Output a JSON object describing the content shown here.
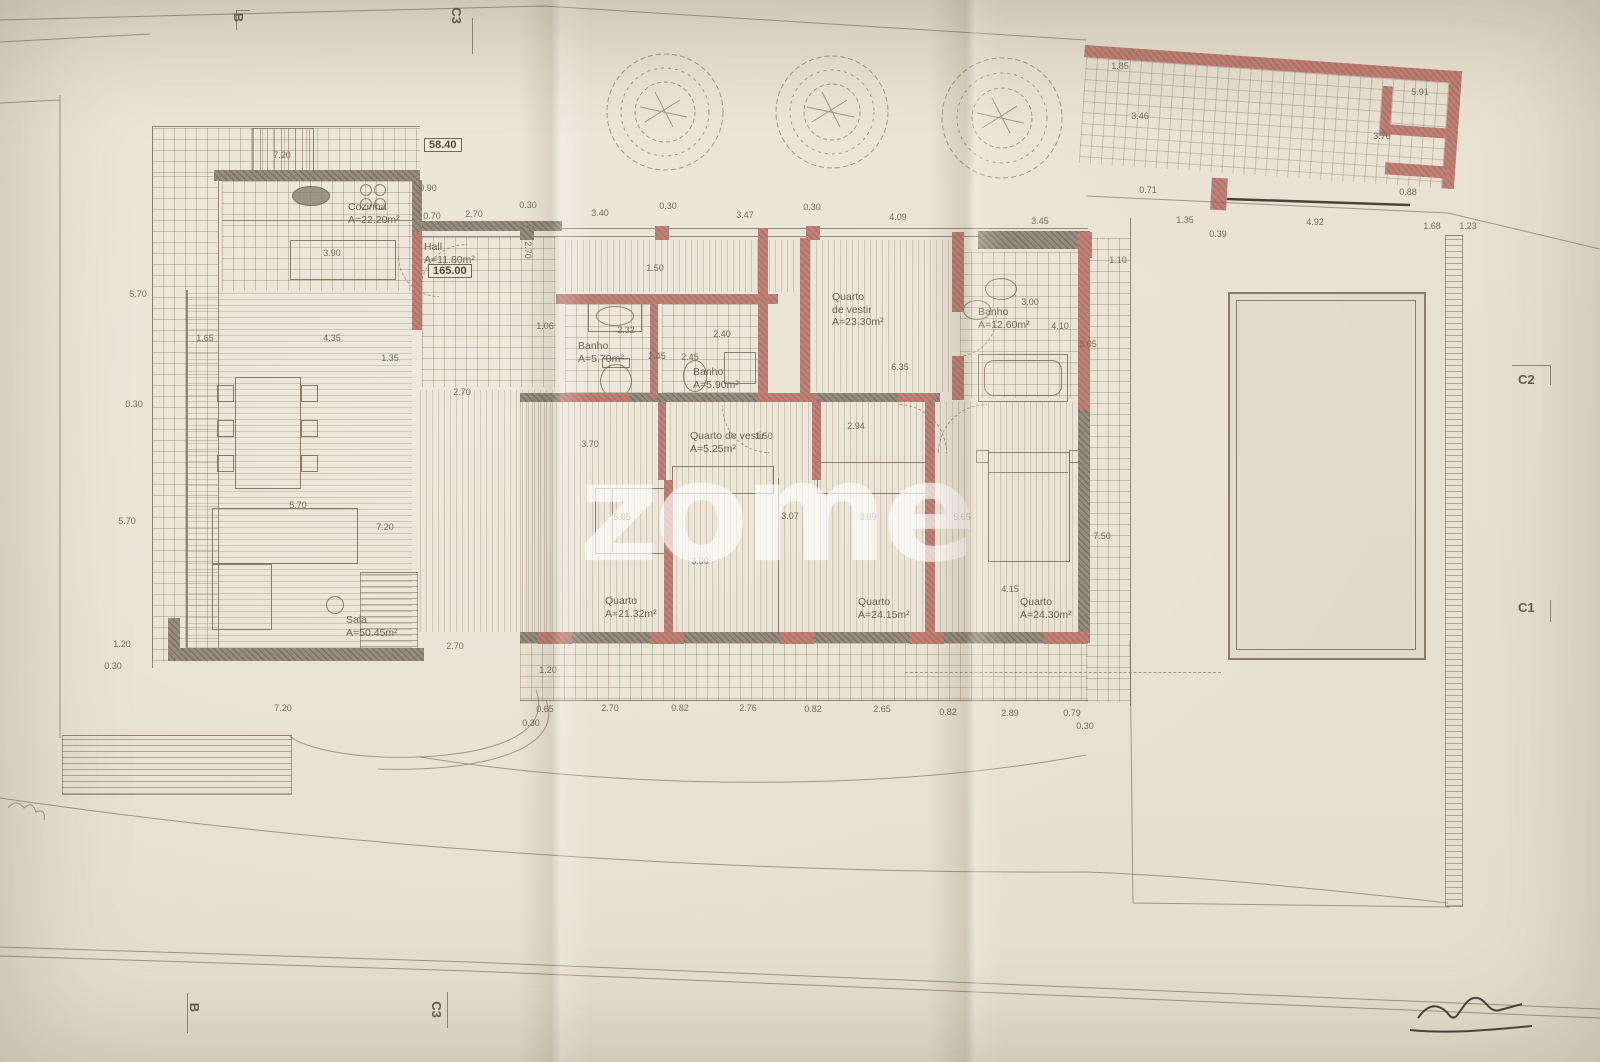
{
  "watermark": "zome",
  "colors": {
    "paper": "#e9e2d3",
    "wall_gray": "#978d7f",
    "wall_red": "#bd8177",
    "ink": "#746b5d",
    "signature": "#38332b"
  },
  "plan": {
    "rooms": [
      {
        "id": "cozinha",
        "lines": [
          "Cozinha",
          "A=22.20m²"
        ],
        "x": 348,
        "y": 201
      },
      {
        "id": "hall",
        "lines": [
          "Hall",
          "A=11.80m²"
        ],
        "x": 424,
        "y": 241
      },
      {
        "id": "banho-1",
        "lines": [
          "Banho",
          "A=5.70m²"
        ],
        "x": 578,
        "y": 340
      },
      {
        "id": "banho-2",
        "lines": [
          "Banho",
          "A=5.90m²"
        ],
        "x": 693,
        "y": 366
      },
      {
        "id": "quarto-vestir-1",
        "lines": [
          "Quarto",
          "de vestir",
          "A=23.30m²"
        ],
        "x": 832,
        "y": 291
      },
      {
        "id": "banho-3",
        "lines": [
          "Banho",
          "A=12.60m²"
        ],
        "x": 978,
        "y": 306
      },
      {
        "id": "quarto-vestir-2",
        "lines": [
          "Quarto de vestir",
          "A=5.25m²"
        ],
        "x": 690,
        "y": 430
      },
      {
        "id": "quarto-1",
        "lines": [
          "Quarto",
          "A=21.32m²"
        ],
        "x": 605,
        "y": 595
      },
      {
        "id": "quarto-2",
        "lines": [
          "Quarto",
          "A=24.15m²"
        ],
        "x": 858,
        "y": 596
      },
      {
        "id": "quarto-3",
        "lines": [
          "Quarto",
          "A=24.30m²"
        ],
        "x": 1020,
        "y": 596
      },
      {
        "id": "sala",
        "lines": [
          "Sala",
          "A=50.45m²"
        ],
        "x": 346,
        "y": 614
      }
    ],
    "boxed": [
      {
        "text": "58.40",
        "x": 424,
        "y": 138
      },
      {
        "text": "165.00",
        "x": 428,
        "y": 264
      }
    ],
    "section_markers": {
      "top_left": "B",
      "top_right": "C3",
      "bottom_left": "B",
      "bottom_right": "C3",
      "right_upper": "C2",
      "right_lower": "C1"
    },
    "dimensions": [
      {
        "t": "0.90",
        "x": 428,
        "y": 188
      },
      {
        "t": "0.70",
        "x": 432,
        "y": 216
      },
      {
        "t": "2.70",
        "x": 474,
        "y": 214
      },
      {
        "t": "0.30",
        "x": 528,
        "y": 205
      },
      {
        "t": "3.40",
        "x": 600,
        "y": 213
      },
      {
        "t": "0.30",
        "x": 668,
        "y": 206
      },
      {
        "t": "3.47",
        "x": 745,
        "y": 215
      },
      {
        "t": "0.30",
        "x": 812,
        "y": 207
      },
      {
        "t": "4.09",
        "x": 898,
        "y": 217
      },
      {
        "t": "3.45",
        "x": 1040,
        "y": 221
      },
      {
        "t": "1.10",
        "x": 1118,
        "y": 260
      },
      {
        "t": "7.20",
        "x": 282,
        "y": 155
      },
      {
        "t": "5.70",
        "x": 138,
        "y": 294
      },
      {
        "t": "0.30",
        "x": 134,
        "y": 404
      },
      {
        "t": "5.70",
        "x": 127,
        "y": 521
      },
      {
        "t": "1.20",
        "x": 122,
        "y": 644
      },
      {
        "t": "0.30",
        "x": 113,
        "y": 666
      },
      {
        "t": "3.90",
        "x": 332,
        "y": 253
      },
      {
        "t": "1.65",
        "x": 205,
        "y": 338
      },
      {
        "t": "4.35",
        "x": 332,
        "y": 338
      },
      {
        "t": "1.35",
        "x": 390,
        "y": 358
      },
      {
        "t": "5.70",
        "x": 298,
        "y": 505
      },
      {
        "t": "7.20",
        "x": 385,
        "y": 527
      },
      {
        "t": "2.70",
        "x": 462,
        "y": 392
      },
      {
        "t": "2.70",
        "x": 455,
        "y": 646
      },
      {
        "t": "1.20",
        "x": 548,
        "y": 670
      },
      {
        "t": "2.70",
        "x": 528,
        "y": 250,
        "r": 90
      },
      {
        "t": "1.06",
        "x": 545,
        "y": 326
      },
      {
        "t": "1.50",
        "x": 655,
        "y": 268
      },
      {
        "t": "2.32",
        "x": 626,
        "y": 330
      },
      {
        "t": "2.40",
        "x": 722,
        "y": 334
      },
      {
        "t": "2.45",
        "x": 657,
        "y": 356
      },
      {
        "t": "2.45",
        "x": 690,
        "y": 357
      },
      {
        "t": "3.00",
        "x": 1030,
        "y": 302
      },
      {
        "t": "4.10",
        "x": 1060,
        "y": 326
      },
      {
        "t": "3.05",
        "x": 1088,
        "y": 344
      },
      {
        "t": "6.35",
        "x": 900,
        "y": 367
      },
      {
        "t": "2.94",
        "x": 856,
        "y": 426
      },
      {
        "t": "1.50",
        "x": 764,
        "y": 436
      },
      {
        "t": "3.70",
        "x": 590,
        "y": 444
      },
      {
        "t": "5.85",
        "x": 622,
        "y": 517
      },
      {
        "t": "3.00",
        "x": 700,
        "y": 561
      },
      {
        "t": "3.07",
        "x": 790,
        "y": 516
      },
      {
        "t": "3.09",
        "x": 868,
        "y": 517
      },
      {
        "t": "5.65",
        "x": 962,
        "y": 517
      },
      {
        "t": "4.15",
        "x": 1010,
        "y": 589
      },
      {
        "t": "7.50",
        "x": 1102,
        "y": 536
      },
      {
        "t": "7.20",
        "x": 283,
        "y": 708
      },
      {
        "t": "0.30",
        "x": 531,
        "y": 723
      },
      {
        "t": "0.65",
        "x": 545,
        "y": 709
      },
      {
        "t": "2.70",
        "x": 610,
        "y": 708
      },
      {
        "t": "0.82",
        "x": 680,
        "y": 708
      },
      {
        "t": "2.76",
        "x": 748,
        "y": 708
      },
      {
        "t": "0.82",
        "x": 813,
        "y": 709
      },
      {
        "t": "2.65",
        "x": 882,
        "y": 709
      },
      {
        "t": "0.82",
        "x": 948,
        "y": 712
      },
      {
        "t": "2.89",
        "x": 1010,
        "y": 713
      },
      {
        "t": "0.79",
        "x": 1072,
        "y": 713
      },
      {
        "t": "0.30",
        "x": 1085,
        "y": 726
      },
      {
        "t": "1.85",
        "x": 1120,
        "y": 66
      },
      {
        "t": "3.46",
        "x": 1140,
        "y": 116
      },
      {
        "t": "5.91",
        "x": 1420,
        "y": 92
      },
      {
        "t": "3.70",
        "x": 1382,
        "y": 136
      },
      {
        "t": "0.71",
        "x": 1148,
        "y": 190
      },
      {
        "t": "0.88",
        "x": 1408,
        "y": 192
      },
      {
        "t": "1.35",
        "x": 1185,
        "y": 220
      },
      {
        "t": "4.92",
        "x": 1315,
        "y": 222
      },
      {
        "t": "1.68",
        "x": 1432,
        "y": 226
      },
      {
        "t": "0.39",
        "x": 1218,
        "y": 234
      },
      {
        "t": "1.23",
        "x": 1468,
        "y": 226
      }
    ]
  }
}
